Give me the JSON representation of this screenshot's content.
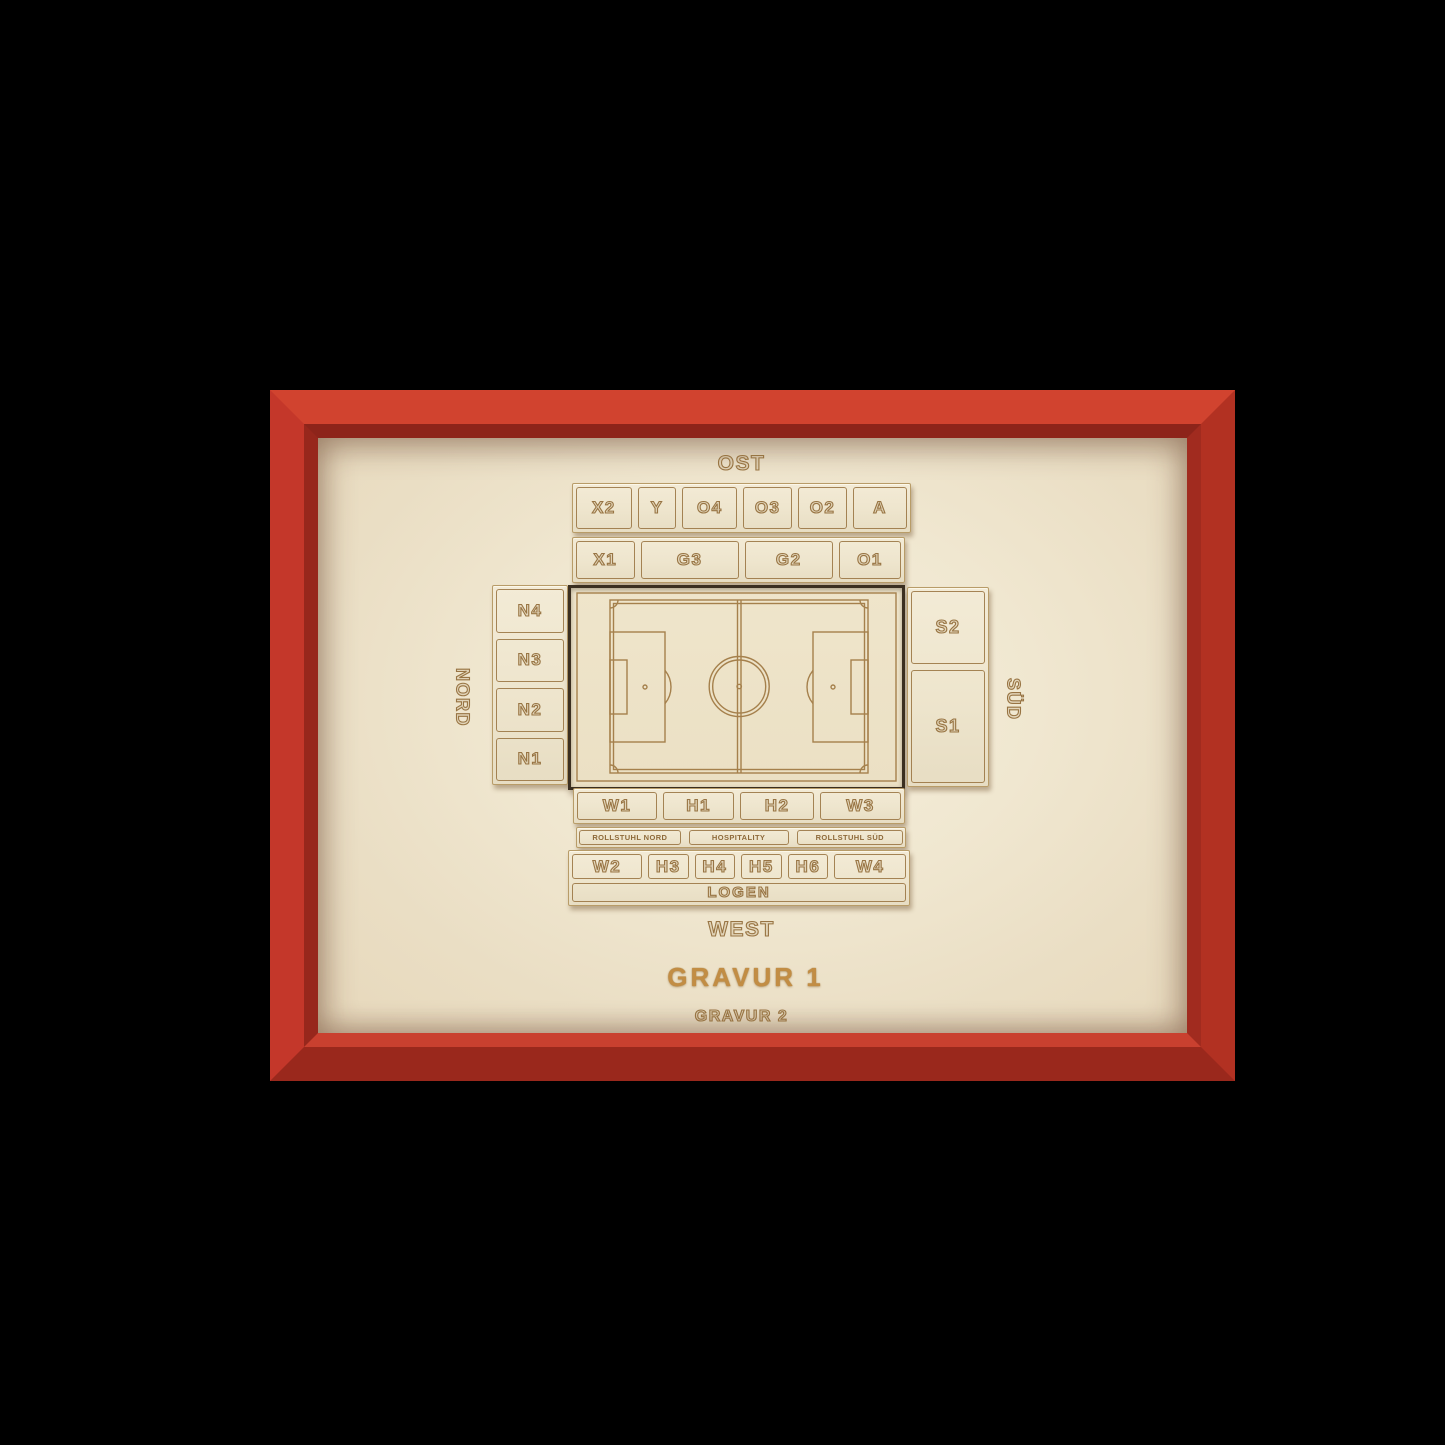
{
  "colors": {
    "background": "#000000",
    "frame_red": "#c4372a",
    "mat_wood": "#eee3cb",
    "plank_wood": "#efe7d2",
    "engrave_brown": "#9c7743",
    "pitch_gap_dark": "#3b2f20",
    "gravur1_gold": "#c28d44"
  },
  "stadium": {
    "ost_label": "OST",
    "west_label": "WEST",
    "nord_label": "NORD",
    "sued_label": "SÜD",
    "east_row1": [
      "X2",
      "Y",
      "O4",
      "O3",
      "O2",
      "A"
    ],
    "east_row2": [
      "X1",
      "G3",
      "G2",
      "O1"
    ],
    "north_column": [
      "N4",
      "N3",
      "N2",
      "N1"
    ],
    "south_column": [
      "S2",
      "S1"
    ],
    "west_row1": [
      "W1",
      "H1",
      "H2",
      "W3"
    ],
    "west_row2": [
      "ROLLSTUHL NORD",
      "HOSPITALITY",
      "ROLLSTUHL SÜD"
    ],
    "west_row3": [
      "W2",
      "H3",
      "H4",
      "H5",
      "H6",
      "W4"
    ],
    "logen_label": "LOGEN",
    "gravur1": "GRAVUR 1",
    "gravur2": "GRAVUR 2"
  }
}
